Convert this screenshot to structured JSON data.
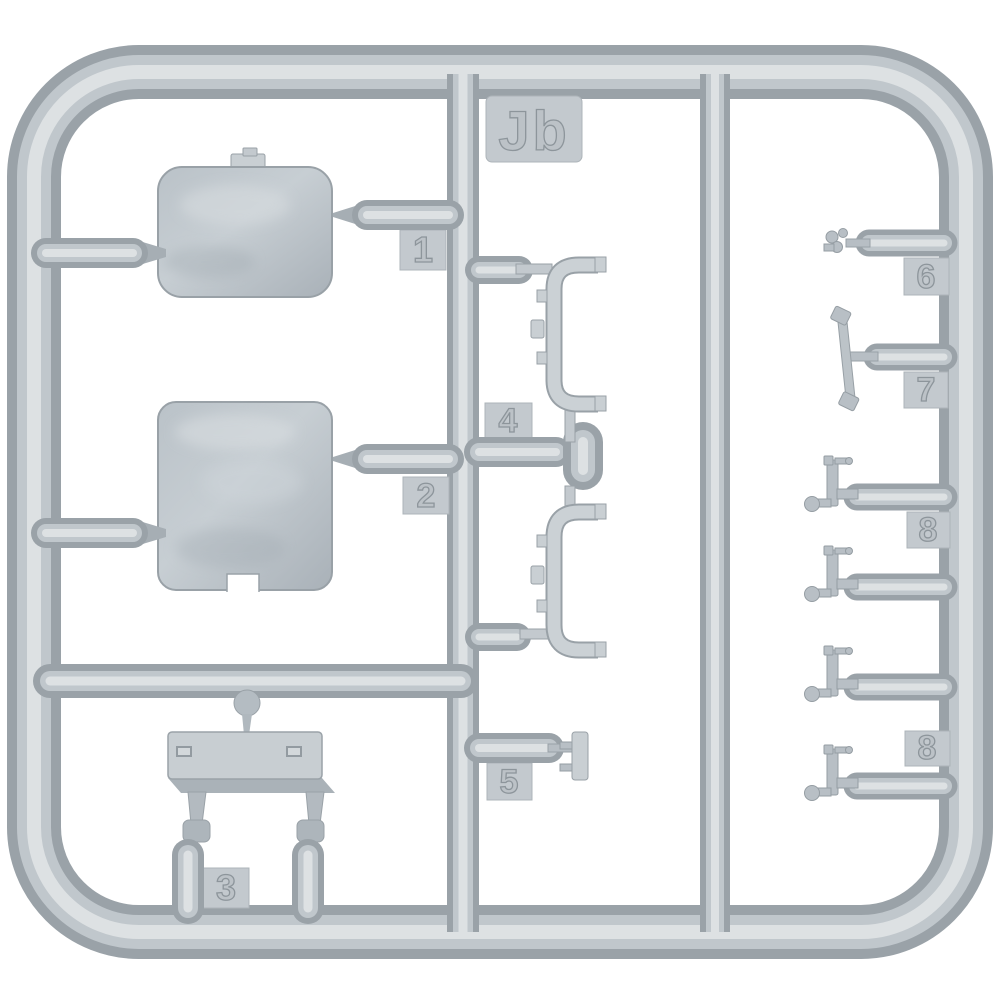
{
  "sprue": {
    "code": "Jb",
    "tags": [
      {
        "id": "jb",
        "label": "Jb"
      },
      {
        "id": "1",
        "label": "1"
      },
      {
        "id": "2",
        "label": "2"
      },
      {
        "id": "3",
        "label": "3"
      },
      {
        "id": "4",
        "label": "4"
      },
      {
        "id": "5",
        "label": "5"
      },
      {
        "id": "6",
        "label": "6"
      },
      {
        "id": "7",
        "label": "7"
      },
      {
        "id": "8a",
        "label": "8"
      },
      {
        "id": "8b",
        "label": "8"
      }
    ],
    "colors": {
      "background": "#ffffff",
      "plastic_edge": "#9aa2a8",
      "plastic_mid": "#c0c7cc",
      "plastic_highlight": "#dde1e3",
      "tag_fill": "#c3c9ce"
    }
  }
}
